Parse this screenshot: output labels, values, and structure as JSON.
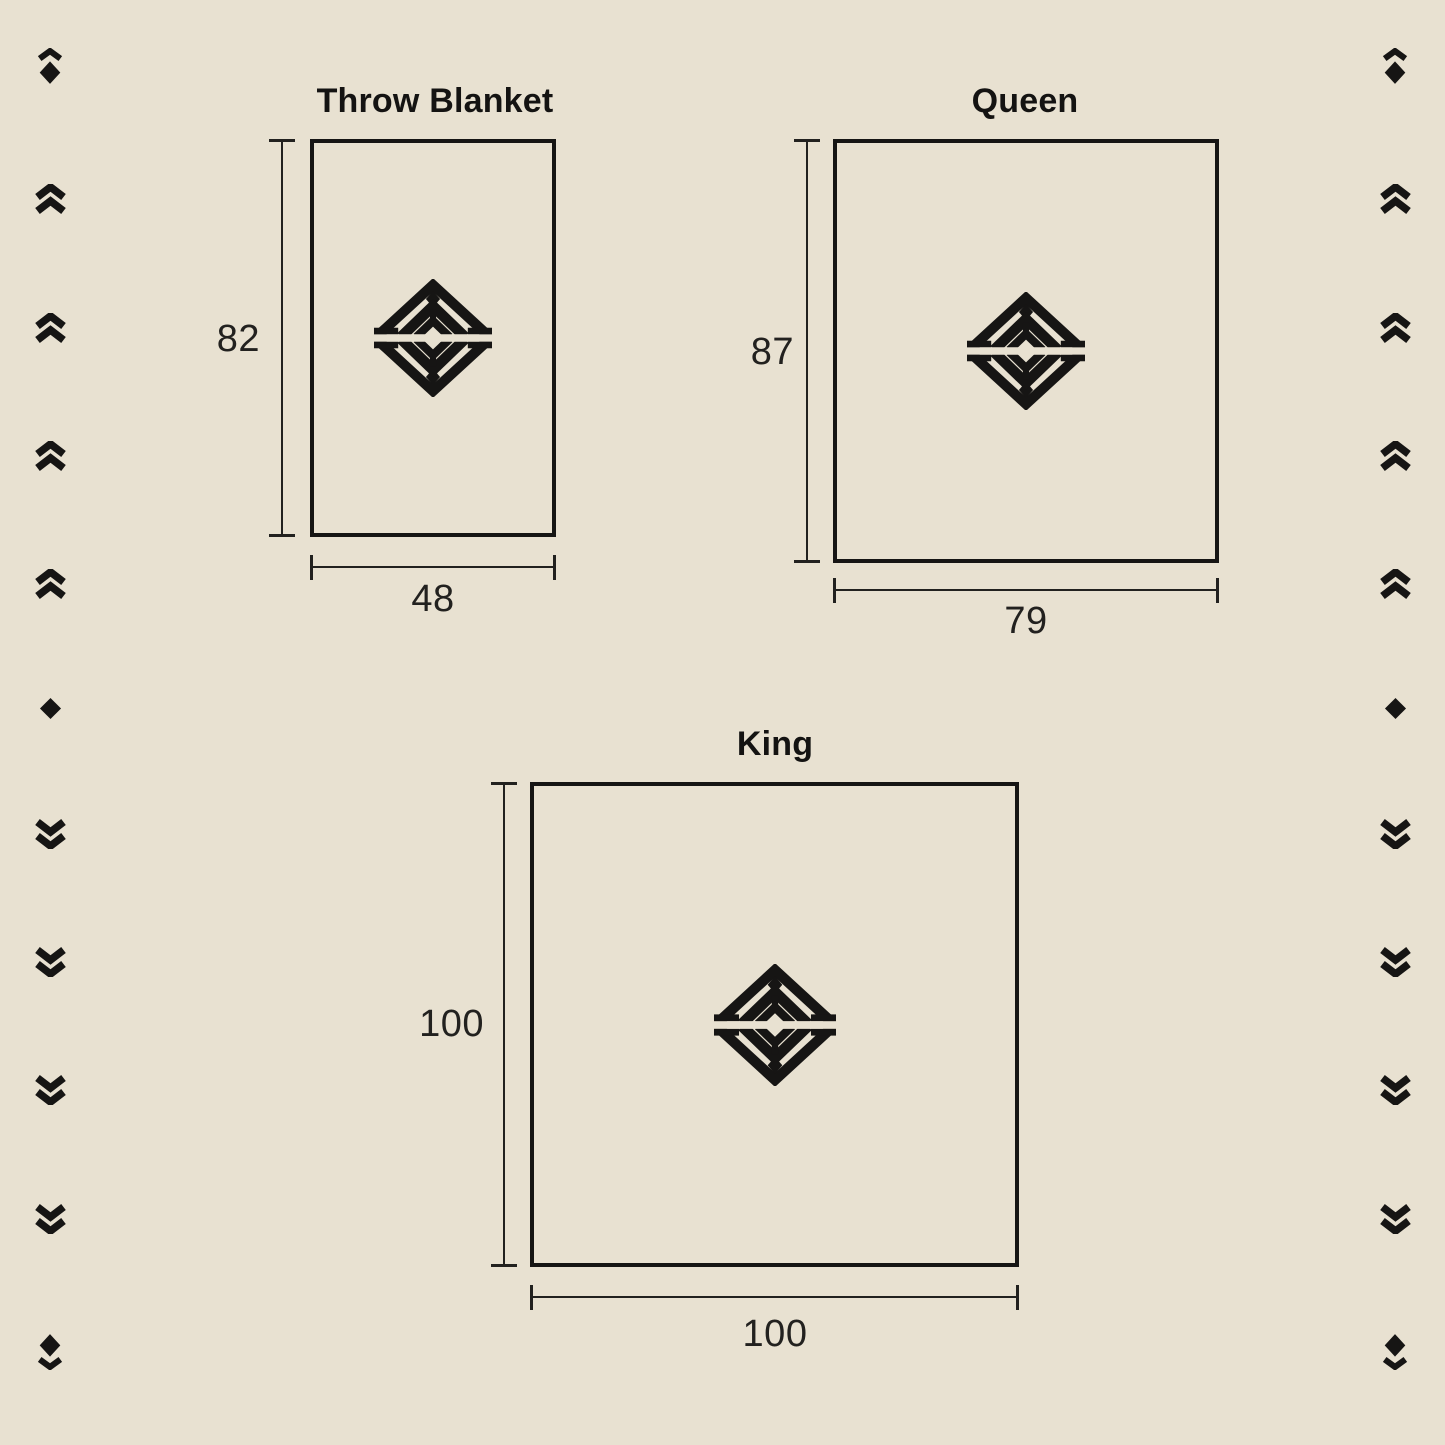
{
  "page": {
    "background_color": "#e8e1d1",
    "ink_color": "#1a1918",
    "description": "Blanket size guide diagram"
  },
  "sizes": [
    {
      "id": "throw",
      "label": "Throw Blanket",
      "height": "82",
      "width": "48"
    },
    {
      "id": "queen",
      "label": "Queen",
      "height": "87",
      "width": "79"
    },
    {
      "id": "king",
      "label": "King",
      "height": "100",
      "width": "100"
    }
  ],
  "logo": {
    "icon": "brand-diamond-logo-icon"
  },
  "ornaments": {
    "left": [
      "chevron-diamond",
      "double-chevron-up",
      "double-chevron-up",
      "double-chevron-up",
      "double-chevron-up",
      "diamond",
      "double-chevron-down",
      "double-chevron-down",
      "double-chevron-down",
      "double-chevron-down",
      "diamond-chevron"
    ],
    "right": [
      "chevron-diamond",
      "double-chevron-up",
      "double-chevron-up",
      "double-chevron-up",
      "double-chevron-up",
      "diamond",
      "double-chevron-down",
      "double-chevron-down",
      "double-chevron-down",
      "double-chevron-down",
      "diamond-chevron"
    ]
  }
}
